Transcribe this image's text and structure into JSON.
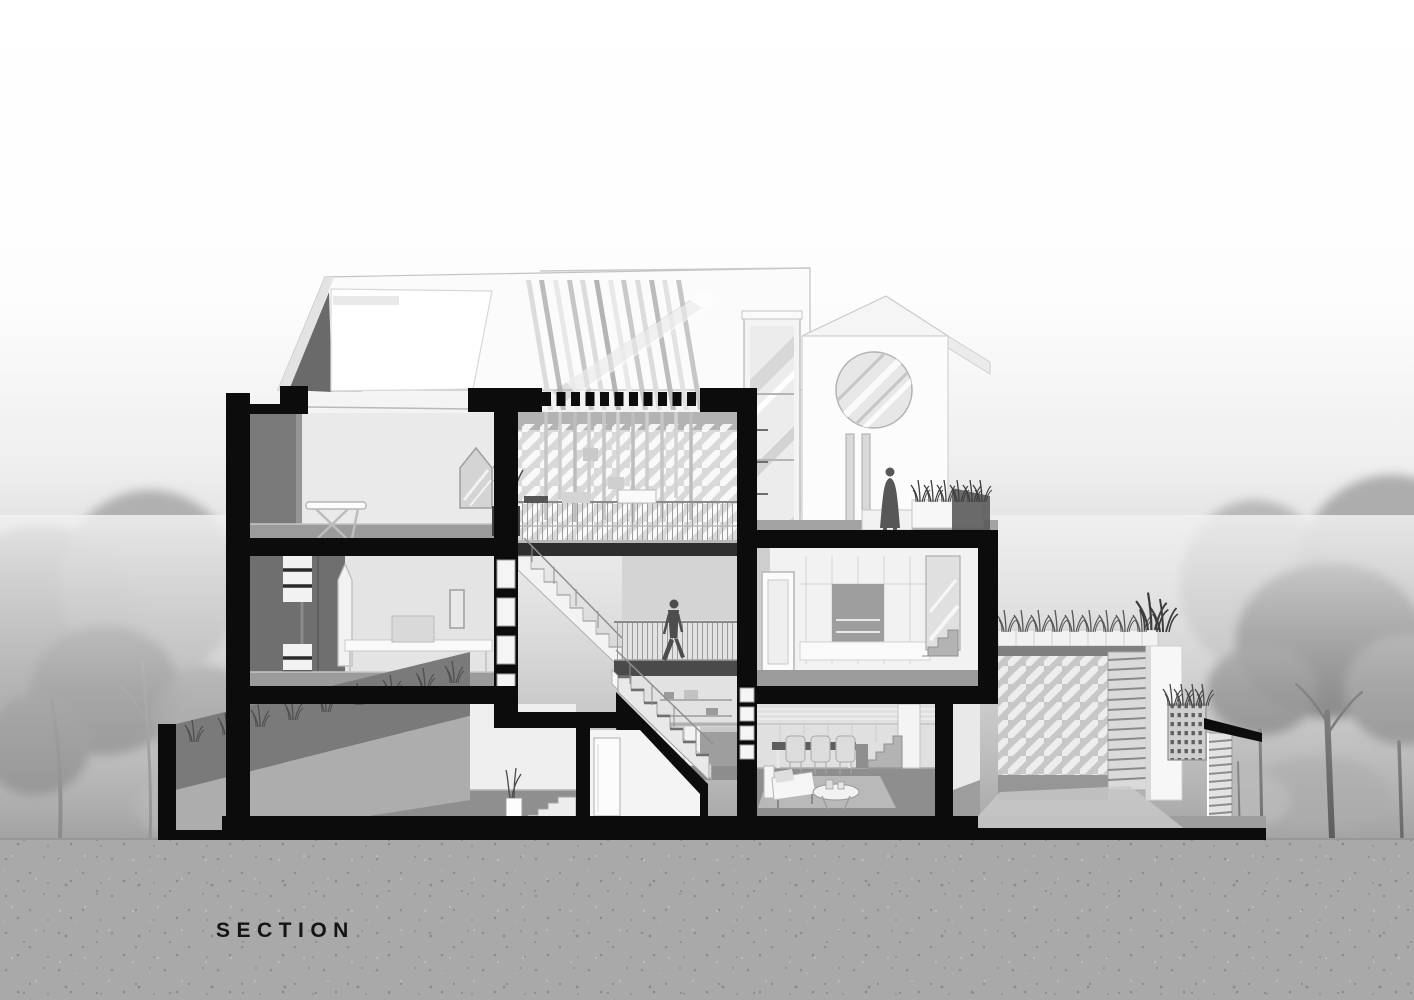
{
  "label": {
    "text": "SECTION"
  },
  "drawing": {
    "type": "architectural-cross-section",
    "figures": [
      {
        "id": "man-walking",
        "location": "atrium-mezzanine"
      },
      {
        "id": "woman-standing",
        "location": "roof-terrace"
      }
    ],
    "elements": [
      "sloped-roof-with-skylight",
      "louver-screen",
      "glass-stair-tower",
      "tower-with-round-window",
      "roof-terrace-with-planter",
      "attic-bedroom",
      "second-floor-bedroom",
      "ground-floor-room",
      "atrium-bridge",
      "atrium-stair-flights",
      "mezzanine-landing",
      "kitchen-counter",
      "dressing-room",
      "dining-living-room",
      "garage-with-green-roof",
      "perforated-fence",
      "louvered-gate-post",
      "front-yard-wall-with-grass",
      "background-trees",
      "speckled-ground"
    ]
  },
  "palette": {
    "cut_poche": "#0c0c0c",
    "roof_white": "#fcfcfc",
    "wall_light": "#ececec",
    "wall_mid": "#d9d9d9",
    "side_wall_dark": "#6f6f6f",
    "floor_gray": "#909090",
    "figure_silhouette": "#4d4d4d",
    "tree_dark": "#6e6e6e",
    "tree_light": "#a6a6a6",
    "ground": "#a9a9a9",
    "label_text": "#141414"
  }
}
